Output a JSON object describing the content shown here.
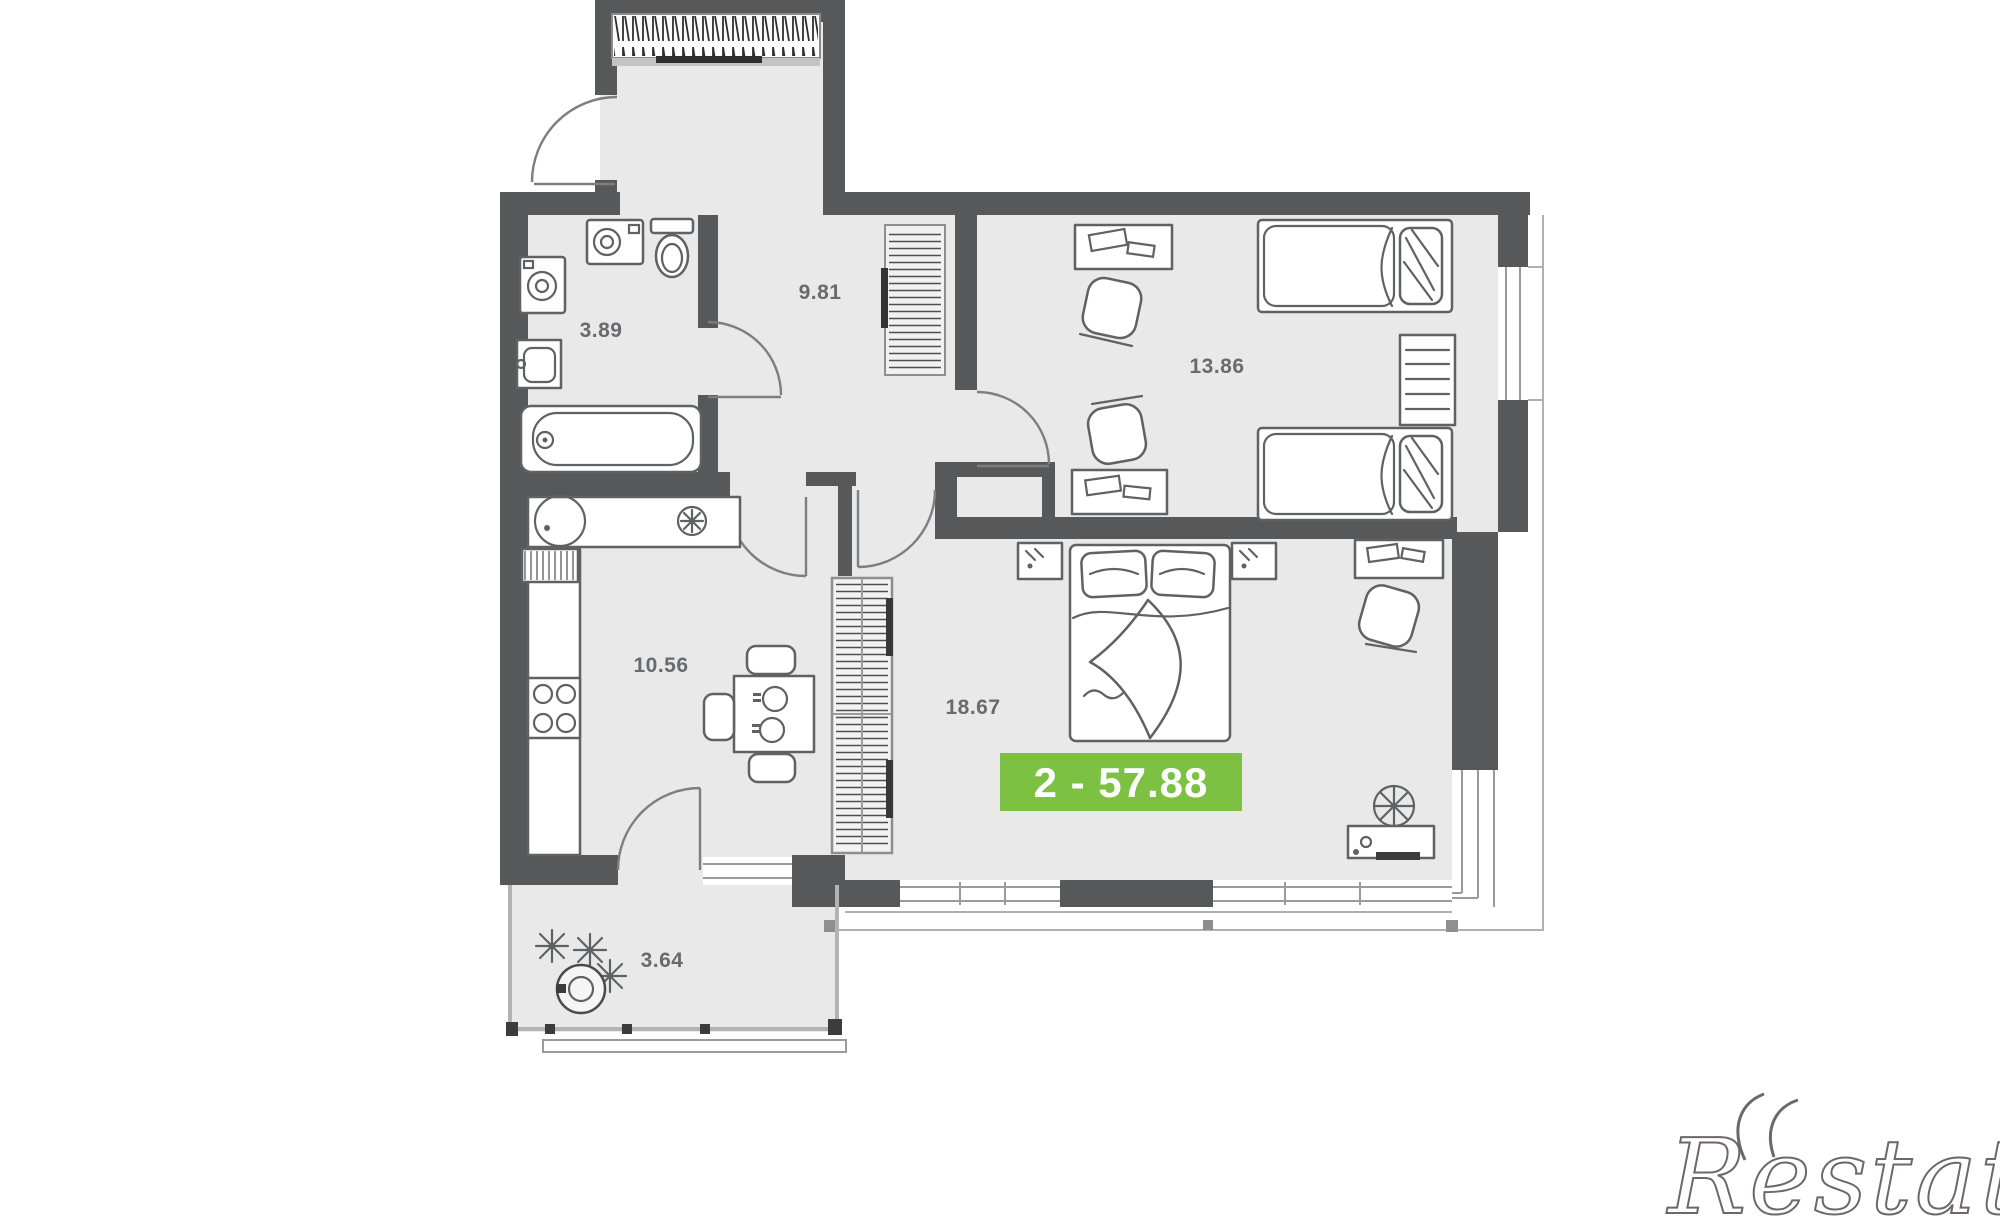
{
  "floor_plan": {
    "rooms": [
      {
        "id": "bathroom",
        "area": "3.89"
      },
      {
        "id": "hallway",
        "area": "9.81"
      },
      {
        "id": "bedroom",
        "area": "13.86"
      },
      {
        "id": "kitchen",
        "area": "10.56"
      },
      {
        "id": "living-room",
        "area": "18.67"
      },
      {
        "id": "balcony",
        "area": "3.64"
      }
    ],
    "badge": {
      "text": "2 - 57.88",
      "rooms_count": "2",
      "total_area": "57.88"
    },
    "watermark": {
      "text": "Restate"
    },
    "colors": {
      "wall": "#57585a",
      "floor": "#e9e9e9",
      "furniture_line": "#606163",
      "window_frame": "#9b9b9b",
      "badge_bg": "#7cc142",
      "badge_text": "#ffffff",
      "label_text": "#696a6c",
      "watermark": "#6e6769"
    },
    "icons": [
      "hanger-closet-icon",
      "washing-machine-icon",
      "toilet-icon",
      "bathroom-sink-icon",
      "bathtub-icon",
      "kitchen-sink-icon",
      "hob-burner-icon",
      "stove-icon",
      "dining-table-icon",
      "chair-icon",
      "radiator-icon",
      "wardrobe-icon",
      "desk-icon",
      "desk-chair-icon",
      "single-bed-icon",
      "bookshelf-icon",
      "double-bed-icon",
      "nightstand-lamp-icon",
      "dressing-table-icon",
      "mirror-icon",
      "plant-icon",
      "door-arc-icon",
      "window-icon"
    ]
  }
}
